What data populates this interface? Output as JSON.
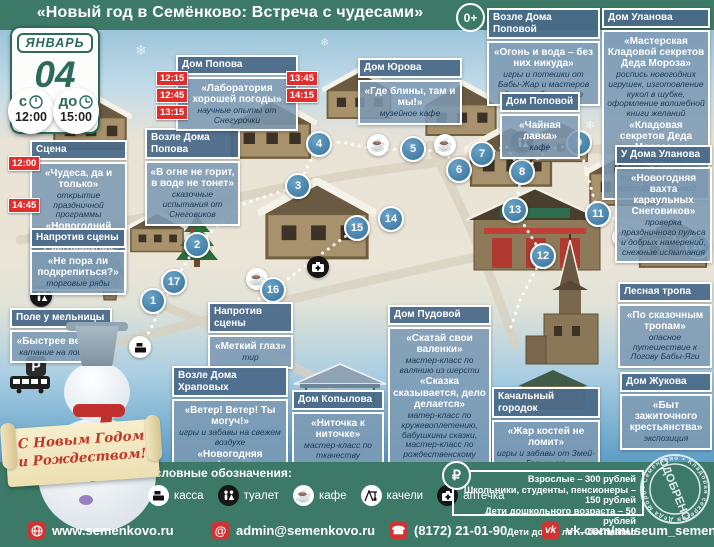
{
  "header": {
    "title": "«Новый год в Семёнково: Встреча с чудесами»",
    "age_badge": "0+"
  },
  "calendar": {
    "month": "ЯНВАРЬ",
    "day": "04",
    "from_label": "с",
    "from_time": "12:00",
    "to_label": "до",
    "to_time": "15:00"
  },
  "boxes": {
    "scena": {
      "header": "Сцена",
      "events": [
        {
          "time": "12:00",
          "name": "«Чудеса, да и только»",
          "desc": "открытие праздничной программы"
        },
        {
          "time": "14:45",
          "name": "«Новогодний флешмоб Снеговичков»",
          "desc": "закрытие праздничной программы"
        }
      ]
    },
    "naprotiv_food": {
      "header": "Напротив сцены",
      "events": [
        {
          "name": "«Не пора ли подкрепиться?»",
          "desc": "торговые ряды"
        }
      ]
    },
    "pole": {
      "header": "Поле у мельницы",
      "events": [
        {
          "name": "«Быстрее ветра!»",
          "desc": "катание на лошадях"
        }
      ]
    },
    "tir": {
      "header": "Напротив сцены",
      "events": [
        {
          "name": "«Меткий глаз»",
          "desc": "тир"
        }
      ]
    },
    "vozle_popova": {
      "header": "Возле Дома Попова",
      "events": [
        {
          "name": "«В огне не горит, в воде не тонет»",
          "desc": "сказочные испытания от Снеговиков"
        }
      ]
    },
    "popov": {
      "header": "Дом Попова",
      "times_left": [
        "12:15",
        "12:45",
        "13:15"
      ],
      "times_right": [
        "13:45",
        "14:15"
      ],
      "events": [
        {
          "name": "«Лаборатория хорошей погоды»",
          "desc": "научные опыты от Снегурочки"
        }
      ]
    },
    "yurov": {
      "header": "Дом Юрова",
      "events": [
        {
          "name": "«Где блины, там и мы!»",
          "desc": "музейное кафе"
        }
      ]
    },
    "vozle_popovoy": {
      "header": "Возле Дома Поповой",
      "events": [
        {
          "name": "«Огонь и вода – без них никуда»",
          "desc": "игры и потешки от Бабы-Жар и мастеров деревни Семенково"
        }
      ]
    },
    "popovoy": {
      "header": "Дом Поповой",
      "events": [
        {
          "name": "«Чайная лавка»",
          "desc": "кафе"
        }
      ]
    },
    "ulanov": {
      "header": "Дом Уланова",
      "events": [
        {
          "name": "«Мастерская Кладовой секретов Деда Мороза»",
          "desc": "роспись новогодних игрушек, изготовление кукол в шубке, оформление волшебной книги желаний"
        },
        {
          "name": "«Кладовая секретов Деда Мороза»",
          "desc": "встреча с Дедом Морозом, посещение тайной комнаты, новогодний хоровод"
        }
      ]
    },
    "u_ulanova": {
      "header": "У Дома Уланова",
      "events": [
        {
          "name": "«Новогодняя вахта караульных Снеговиков»",
          "desc": "проверка праздничного пульса и добрых намерений, снежные испытания"
        }
      ]
    },
    "lesnaya": {
      "header": "Лесная тропа",
      "events": [
        {
          "name": "«По сказочным тропам»",
          "desc": "опасное путешествие к Логову Бабы-Яги"
        }
      ]
    },
    "pudovoy": {
      "header": "Дом Пудовой",
      "events": [
        {
          "name": "«Скатай свои валенки»",
          "desc": "мастер-класс по валянию из шерсти"
        },
        {
          "name": "«Сказка сказывается, дело делается»",
          "desc": "матер-класс по кружевоплетению, бабушкины сказки, мастер-класс по рождественскому ангелу"
        }
      ]
    },
    "kopylov": {
      "header": "Дом Копылова",
      "events": [
        {
          "name": "«Ниточка к ниточке»",
          "desc": "мастер-класс по ткачеству"
        }
      ]
    },
    "hrapovy": {
      "header": "Возле Дома Храповых",
      "events": [
        {
          "name": "«Ветер! Ветер! Ты могуч!»",
          "desc": "игры и забавы на свежем воздухе"
        },
        {
          "name": "«Новогодняя арифметика»",
          "desc": "загадки от Снеговиков"
        }
      ]
    },
    "kachalny": {
      "header": "Качальный городок",
      "events": [
        {
          "name": "«Жар костей не ломит»",
          "desc": "игры и забавы от Змей-Горыныча"
        }
      ]
    },
    "zhukov": {
      "header": "Дом Жукова",
      "events": [
        {
          "name": "«Быт зажиточного крестьянства»",
          "desc": "экспозиция"
        }
      ]
    }
  },
  "marker_labels": [
    "1",
    "2",
    "3",
    "4",
    "5",
    "6",
    "7",
    "8",
    "9",
    "10",
    "11",
    "12",
    "13",
    "14",
    "15",
    "16",
    "17"
  ],
  "banner": {
    "line1": "С Новым Годом",
    "line2": "и Рождеством!"
  },
  "legend": {
    "title": "Условные обозначения:",
    "items": [
      {
        "icon": "cash-register-icon",
        "label": "касса"
      },
      {
        "icon": "toilet-icon",
        "label": "туалет"
      },
      {
        "icon": "cafe-icon",
        "label": "кафе"
      },
      {
        "icon": "swing-icon",
        "label": "качели"
      },
      {
        "icon": "first-aid-icon",
        "label": "аптечка"
      }
    ]
  },
  "prices": {
    "currency_symbol": "₽",
    "lines": [
      "Взрослые – 300 рублей",
      "Школьники, студенты, пенсионеры – 150 рублей",
      "Дети дошкольного возраста – 50 рублей",
      "Дети до 3-х лет – бесплатно"
    ]
  },
  "stamp": {
    "center": "ОДОБРЕНО",
    "ring": "• Семёнково • Кладовая секретов Деда Мороза •"
  },
  "footer": {
    "website": "www.semenkovo.ru",
    "email": "admin@semenkovo.ru",
    "phone": "(8172) 21-01-90",
    "vk": "vk.com/museum_semenkovo"
  },
  "map_icon_glyphs": {
    "cafe": "☕",
    "baba_yaga": "☹"
  }
}
